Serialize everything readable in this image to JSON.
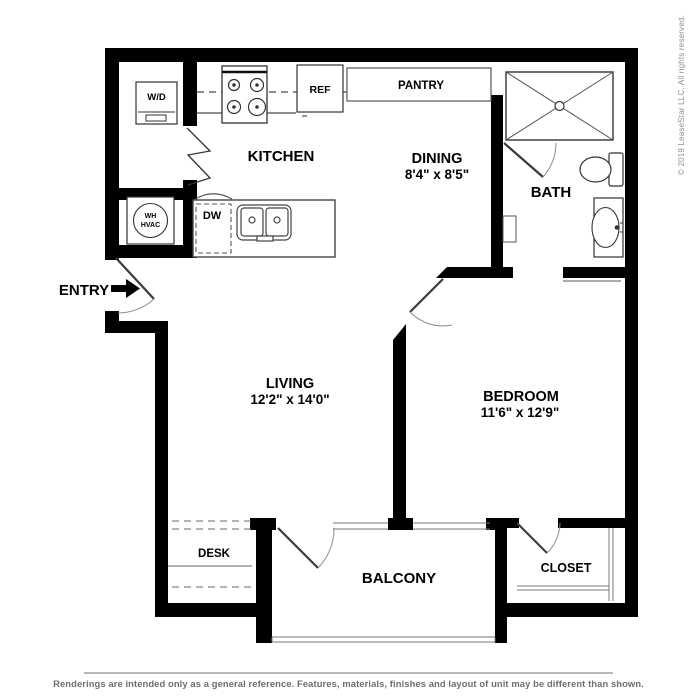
{
  "floorplan": {
    "rooms": {
      "kitchen": {
        "label": "KITCHEN"
      },
      "dining": {
        "label": "DINING",
        "dims": "8'4\" x 8'5\""
      },
      "bath": {
        "label": "BATH"
      },
      "living": {
        "label": "LIVING",
        "dims": "12'2\" x 14'0\""
      },
      "bedroom": {
        "label": "BEDROOM",
        "dims": "11'6\" x 12'9\""
      },
      "balcony": {
        "label": "BALCONY"
      },
      "desk": {
        "label": "DESK"
      },
      "closet": {
        "label": "CLOSET"
      },
      "entry": {
        "label": "ENTRY"
      }
    },
    "fixtures": {
      "washer_dryer": "W/D",
      "water_heater_line1": "WH",
      "water_heater_line2": "HVAC",
      "dishwasher": "DW",
      "refrigerator": "REF",
      "pantry": "PANTRY"
    }
  },
  "watermark": {
    "copyright": "© 2019 LeaseStar LLC. All rights reserved."
  },
  "footer": {
    "disclaimer": "Renderings are intended only as a general reference. Features, materials, finishes and layout of unit may be different than shown."
  },
  "colors": {
    "wall": "#000000",
    "fixture_line": "#4a4a4a",
    "door_arc": "#8c8c8c",
    "footer_text": "#6d6e71",
    "watermark_text": "#8f9092"
  }
}
